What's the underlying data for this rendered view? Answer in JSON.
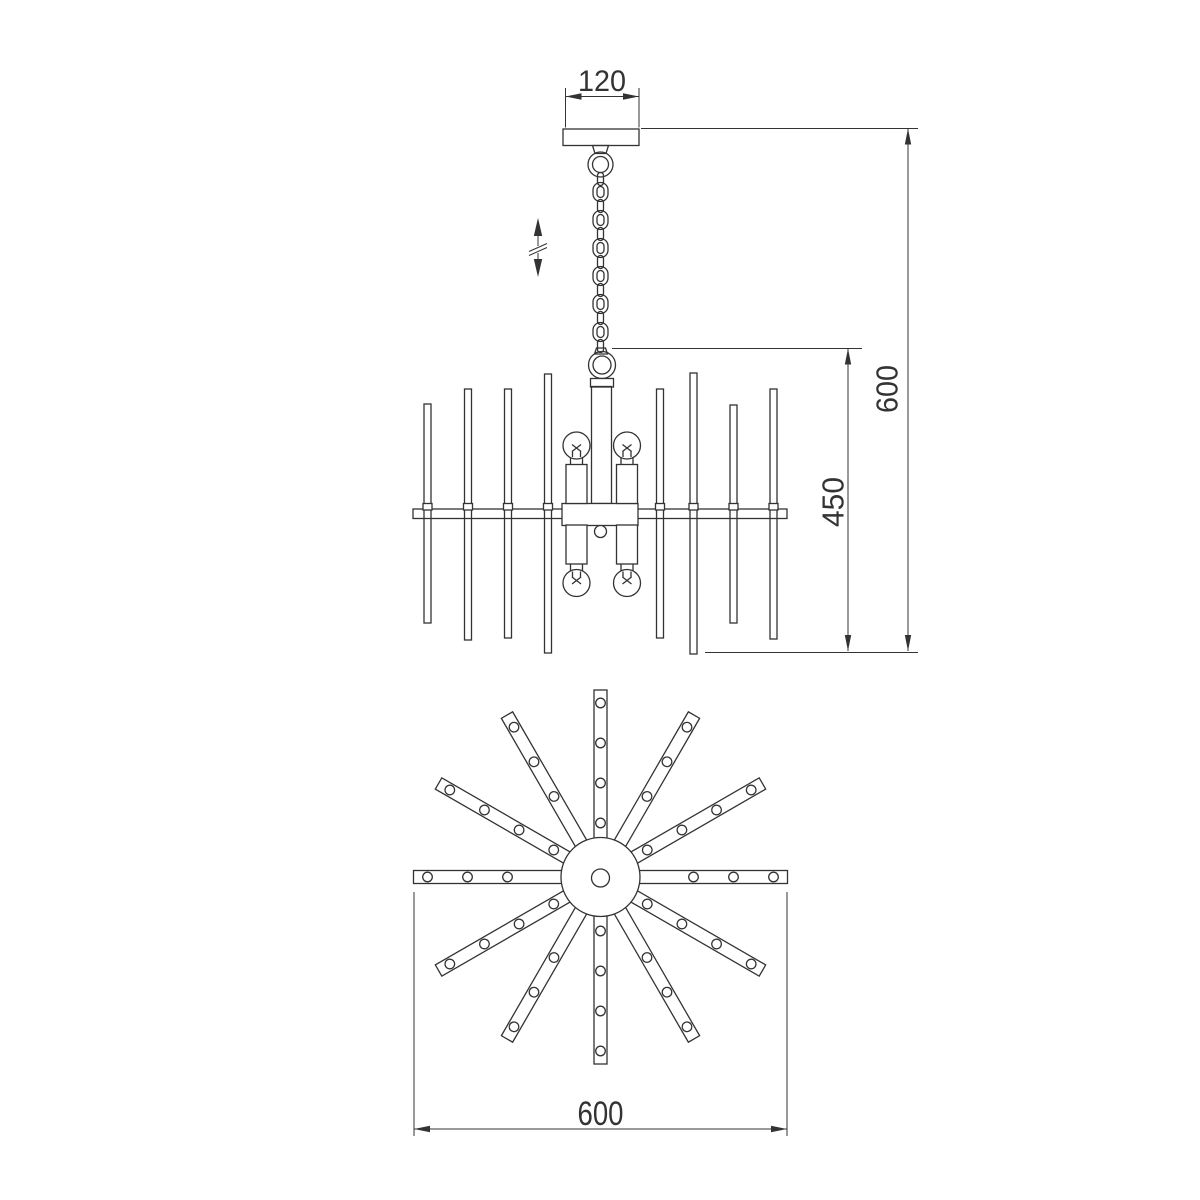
{
  "drawing": {
    "type": "technical-line-drawing",
    "subject": "sputnik-chandelier",
    "views": [
      "front-elevation",
      "bottom-plan"
    ],
    "background_color": "#ffffff",
    "line_color": "#333333"
  },
  "dimensions": {
    "canopy_width": "120",
    "overall_height": "600",
    "body_height": "450",
    "body_diameter": "600"
  },
  "symbols": {
    "height_adjust_icon": "double-headed-arrow-with-break",
    "lamp_count_front_view": 4,
    "plan_arm_count": 12
  }
}
